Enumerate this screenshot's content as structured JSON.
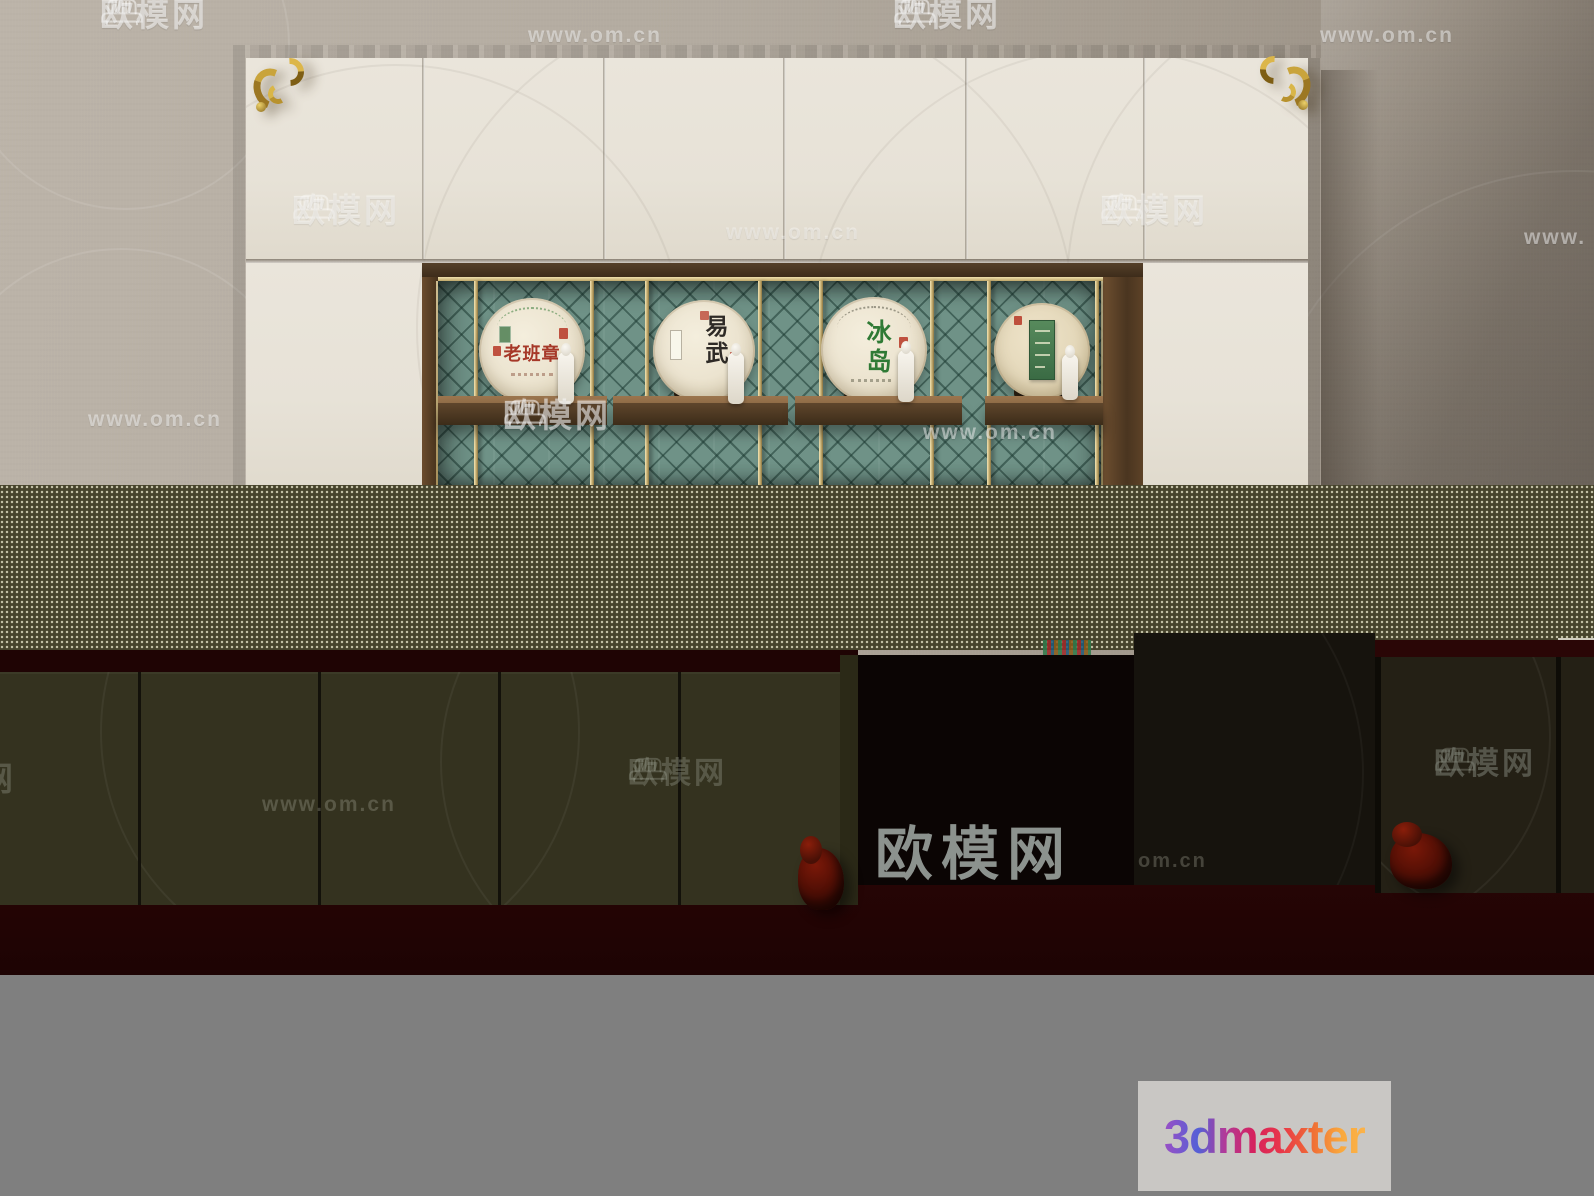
{
  "scene": {
    "description": "3D render of a wall display cabinet with four pu-erh tea discs on shelves, image partly corrupted by glitch bands"
  },
  "watermarks": {
    "brand": "欧模网",
    "url": "www.om.cn",
    "url_short": "om.cn",
    "url_prefix": "www.",
    "brand_partial": "网"
  },
  "cabinet": {
    "discs": [
      {
        "label": "老班章",
        "label_color": "#a63828"
      },
      {
        "label": "易武",
        "label_color": "#2e2a26"
      },
      {
        "label": "冰岛",
        "label_color": "#2f7a35"
      },
      {
        "label": "",
        "label_color": "#4c7f55"
      }
    ]
  },
  "logo": {
    "text": "3dmaxter",
    "background": "#c9c7c4",
    "gradient": [
      "#9a4fc5",
      "#5560d6",
      "#d6215c",
      "#ef6a35",
      "#fbb34a"
    ]
  },
  "colors": {
    "wall": "#b2aa9f",
    "door_white": "#e9e4da",
    "wood_frame": "#7a583b",
    "niche_teal": "#6f9287",
    "brass": "#d8c188",
    "gold_ornament": "#c9a43c",
    "glitch_olive": "#46432c",
    "maroon": "#270505",
    "black_block": "#0b0504",
    "footer_gray": "#7f7f7f"
  }
}
